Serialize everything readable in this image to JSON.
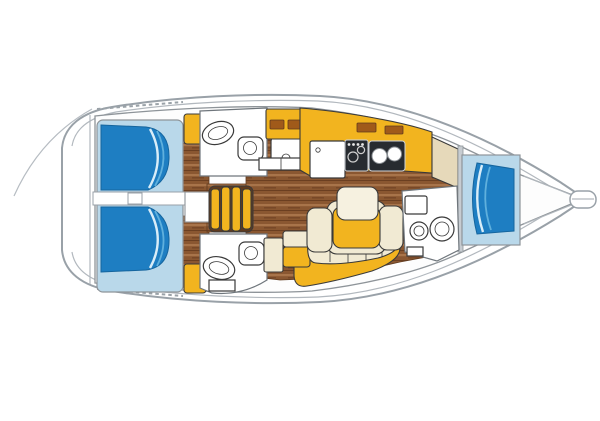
{
  "diagram": {
    "kind": "sailboat-interior-floorplan",
    "orientation": "bow-right"
  },
  "palette": {
    "background": "#ffffff",
    "hull_outline": "#99a1a8",
    "interior_line": "#8e9499",
    "furniture_outline": "#3a3a3a",
    "berth_blue": "#1e7ec2",
    "berth_blue_light": "#b9d8ea",
    "berth_highlight": "#5fb0dd",
    "furniture_yellow": "#f2b41f",
    "cushion_cream": "#f1ead3",
    "seatback_cream": "#f6f1e0",
    "wood_base": "#8a5731",
    "wood_light": "#a8744a",
    "wood_dark": "#6b3f21",
    "chart_beige": "#e6d9ba",
    "appliance_dark": "#272b30",
    "locker_slot": "#a05a1a",
    "fixture_white": "#ffffff",
    "bulkhead_gray": "#c7ccd1"
  },
  "regions": {
    "aft_cabin_port": "aft-cabin-port-double-berth",
    "aft_cabin_starboard": "aft-cabin-starboard-double-berth",
    "head_port": "aft-head-port-with-sink-and-toilet",
    "head_starboard": "aft-head-starboard-with-sink-and-toilet",
    "companionway": "companionway-steps",
    "galley": "galley-with-fridge-stove-double-sink",
    "saloon": "saloon-dinette-with-table-and-settee",
    "chart_table": "chart-table-area",
    "forward_head": "forward-head-with-toilet-and-sink",
    "forward_cabin": "forward-v-berth-cabin",
    "bow": "bow-anchor-fitting"
  }
}
